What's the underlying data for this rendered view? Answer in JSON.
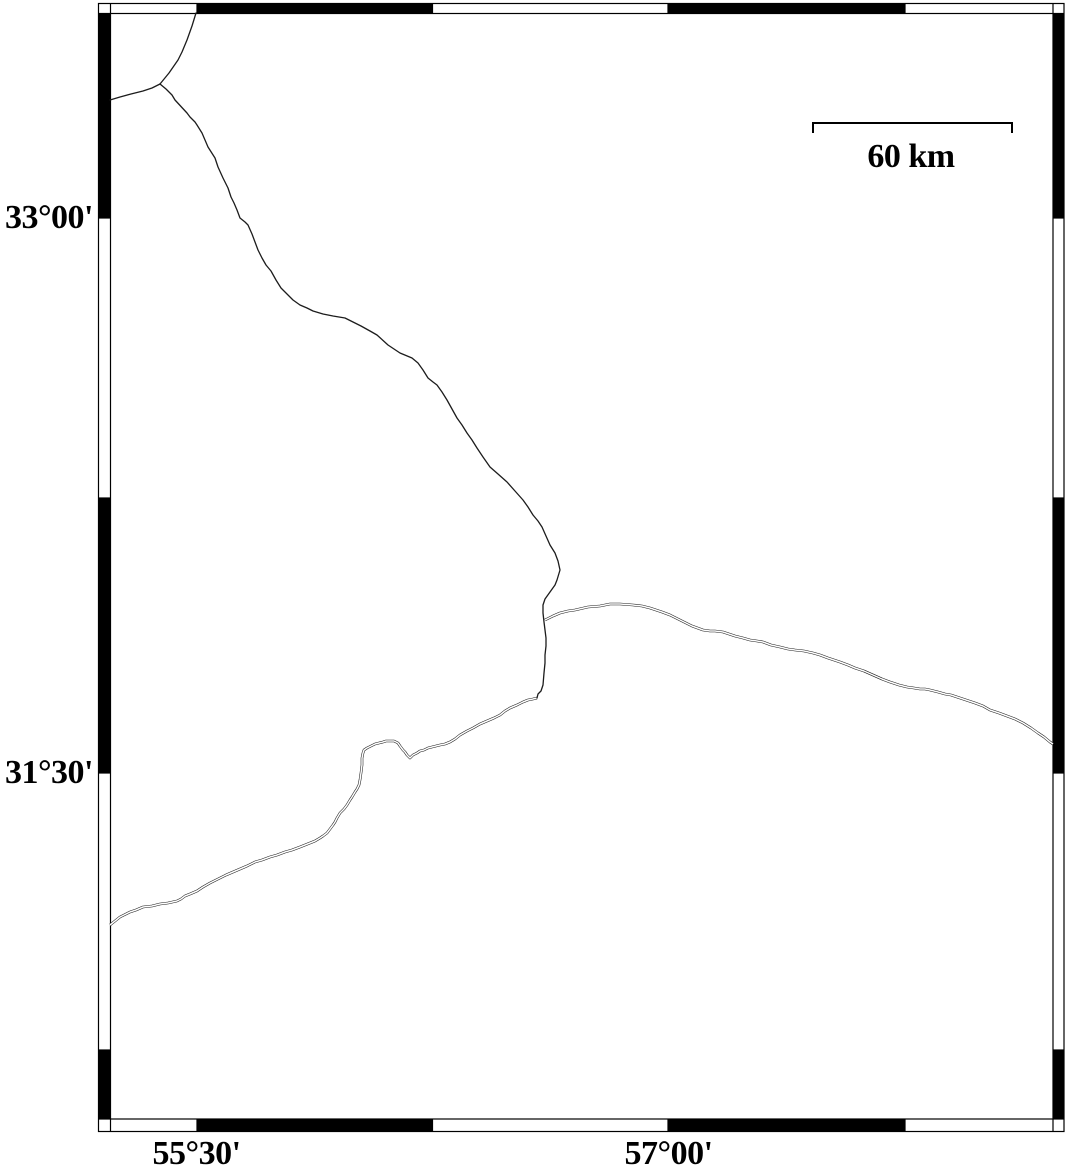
{
  "colors": {
    "ink": "#000000",
    "background": "#ffffff",
    "line": "#1c1c1c"
  },
  "scale_bar": {
    "label": "60 km",
    "x1": 812,
    "x2": 1013,
    "y": 122,
    "tick_height": 11,
    "label_center_x": 911,
    "label_top": 139
  },
  "map_data": {
    "type": "map",
    "grid_annotation_interval": "45 arc-minutes",
    "lat_ticks": [
      {
        "label": "33°00'",
        "y": 218
      },
      {
        "label": "31°30'",
        "y": 773
      }
    ],
    "lon_ticks": [
      {
        "label": "55°30'",
        "x": 196.5
      },
      {
        "label": "57°00'",
        "x": 668.5
      }
    ],
    "lon_label_row_y": 1136,
    "frame": {
      "outer": {
        "x1": 98.5,
        "y1": 3.5,
        "x2": 1064,
        "y2": 1131.5
      },
      "inner": {
        "x1": 110.5,
        "y1": 13.5,
        "x2": 1053,
        "y2": 1119
      },
      "x_boundaries": [
        197,
        432.5,
        668,
        905
      ],
      "y_boundaries": [
        218,
        498,
        773,
        1050
      ],
      "top_black": [
        [
          197,
          432.5
        ],
        [
          668,
          905
        ]
      ],
      "bottom_black": [
        [
          197,
          432.5
        ],
        [
          668,
          905
        ]
      ],
      "left_black": [
        [
          13.5,
          218
        ],
        [
          498,
          773
        ],
        [
          1050,
          1119
        ]
      ],
      "right_black": [
        [
          13.5,
          218
        ],
        [
          498,
          773
        ],
        [
          1050,
          1119
        ]
      ]
    },
    "lines": [
      {
        "id": "boundary-north",
        "kind": "boundary",
        "points": [
          [
            196,
            13
          ],
          [
            192,
            26
          ],
          [
            187,
            40
          ],
          [
            182,
            52
          ],
          [
            178,
            60
          ],
          [
            169,
            73
          ],
          [
            160,
            84
          ]
        ]
      },
      {
        "id": "boundary-west-branch",
        "kind": "boundary",
        "points": [
          [
            160,
            84
          ],
          [
            152,
            88
          ],
          [
            143,
            91
          ],
          [
            131,
            94
          ],
          [
            120,
            97
          ],
          [
            110,
            100
          ]
        ]
      },
      {
        "id": "boundary-main",
        "kind": "boundary",
        "points": [
          [
            160,
            84
          ],
          [
            166,
            89
          ],
          [
            172,
            95
          ],
          [
            175,
            100
          ],
          [
            187,
            113
          ],
          [
            190,
            117
          ],
          [
            195,
            122
          ],
          [
            197,
            125
          ],
          [
            202,
            133
          ],
          [
            208,
            147
          ],
          [
            215,
            158
          ],
          [
            218,
            167
          ],
          [
            223,
            178
          ],
          [
            228,
            188
          ],
          [
            231,
            197
          ],
          [
            234,
            203
          ],
          [
            237,
            210
          ],
          [
            240,
            218
          ],
          [
            245,
            222
          ],
          [
            248,
            225
          ],
          [
            252,
            234
          ],
          [
            255,
            242
          ],
          [
            258,
            250
          ],
          [
            262,
            258
          ],
          [
            266,
            265
          ],
          [
            271,
            271
          ],
          [
            276,
            280
          ],
          [
            281,
            288
          ],
          [
            287,
            294
          ],
          [
            293,
            300
          ],
          [
            300,
            305
          ],
          [
            307,
            308
          ],
          [
            313,
            311
          ],
          [
            323,
            314
          ],
          [
            333,
            316
          ],
          [
            345,
            318
          ],
          [
            353,
            322
          ],
          [
            361,
            326
          ],
          [
            370,
            331
          ],
          [
            377,
            335
          ],
          [
            388,
            345
          ],
          [
            400,
            353
          ],
          [
            412,
            358
          ],
          [
            418,
            363
          ],
          [
            423,
            370
          ],
          [
            428,
            378
          ],
          [
            433,
            382
          ],
          [
            437,
            385
          ],
          [
            442,
            392
          ],
          [
            447,
            400
          ],
          [
            452,
            409
          ],
          [
            457,
            418
          ],
          [
            462,
            425
          ],
          [
            467,
            433
          ],
          [
            472,
            440
          ],
          [
            477,
            448
          ],
          [
            483,
            457
          ],
          [
            490,
            467
          ],
          [
            498,
            474
          ],
          [
            507,
            482
          ],
          [
            515,
            491
          ],
          [
            523,
            500
          ],
          [
            528,
            507
          ],
          [
            533,
            515
          ],
          [
            538,
            521
          ],
          [
            542,
            527
          ],
          [
            546,
            536
          ],
          [
            550,
            545
          ],
          [
            555,
            553
          ],
          [
            558,
            561
          ],
          [
            560,
            570
          ],
          [
            557,
            580
          ],
          [
            555,
            585
          ],
          [
            550,
            592
          ],
          [
            545,
            599
          ],
          [
            543,
            605
          ],
          [
            543,
            613
          ],
          [
            544,
            622
          ],
          [
            545,
            630
          ],
          [
            546,
            638
          ],
          [
            546,
            646
          ],
          [
            545,
            655
          ],
          [
            545,
            663
          ],
          [
            544,
            673
          ],
          [
            543,
            685
          ],
          [
            541,
            691
          ],
          [
            538,
            694
          ],
          [
            537,
            698
          ]
        ]
      },
      {
        "id": "river-east",
        "kind": "river",
        "points": [
          [
            545,
            620
          ],
          [
            553,
            616
          ],
          [
            560,
            613
          ],
          [
            568,
            611
          ],
          [
            575,
            610
          ],
          [
            588,
            607
          ],
          [
            600,
            606
          ],
          [
            610,
            604
          ],
          [
            620,
            604
          ],
          [
            633,
            605
          ],
          [
            642,
            606
          ],
          [
            650,
            608
          ],
          [
            656,
            610
          ],
          [
            662,
            612
          ],
          [
            670,
            615
          ],
          [
            680,
            620
          ],
          [
            686,
            623
          ],
          [
            692,
            626
          ],
          [
            703,
            630
          ],
          [
            710,
            631
          ],
          [
            715,
            631
          ],
          [
            723,
            632
          ],
          [
            729,
            634
          ],
          [
            735,
            636
          ],
          [
            743,
            638
          ],
          [
            750,
            640
          ],
          [
            757,
            641
          ],
          [
            763,
            642
          ],
          [
            771,
            645
          ],
          [
            780,
            647
          ],
          [
            788,
            649
          ],
          [
            795,
            650
          ],
          [
            804,
            651
          ],
          [
            813,
            653
          ],
          [
            820,
            655
          ],
          [
            828,
            658
          ],
          [
            834,
            660
          ],
          [
            840,
            662
          ],
          [
            848,
            665
          ],
          [
            855,
            668
          ],
          [
            864,
            671
          ],
          [
            873,
            675
          ],
          [
            882,
            679
          ],
          [
            890,
            682
          ],
          [
            899,
            685
          ],
          [
            907,
            687
          ],
          [
            914,
            688
          ],
          [
            920,
            689
          ],
          [
            925,
            689
          ],
          [
            930,
            690
          ],
          [
            938,
            692
          ],
          [
            945,
            694
          ],
          [
            951,
            695
          ],
          [
            957,
            697
          ],
          [
            966,
            700
          ],
          [
            975,
            703
          ],
          [
            983,
            706
          ],
          [
            990,
            710
          ],
          [
            999,
            713
          ],
          [
            1007,
            716
          ],
          [
            1015,
            719
          ],
          [
            1023,
            723
          ],
          [
            1031,
            728
          ],
          [
            1038,
            733
          ],
          [
            1044,
            737
          ],
          [
            1050,
            742
          ],
          [
            1053,
            744
          ]
        ]
      },
      {
        "id": "river-southwest",
        "kind": "river",
        "points": [
          [
            537,
            698
          ],
          [
            533,
            699
          ],
          [
            528,
            700
          ],
          [
            523,
            702
          ],
          [
            517,
            705
          ],
          [
            510,
            708
          ],
          [
            505,
            711
          ],
          [
            500,
            715
          ],
          [
            494,
            718
          ],
          [
            487,
            721
          ],
          [
            480,
            724
          ],
          [
            473,
            728
          ],
          [
            467,
            731
          ],
          [
            460,
            735
          ],
          [
            455,
            739
          ],
          [
            450,
            742
          ],
          [
            445,
            744
          ],
          [
            440,
            745
          ],
          [
            436,
            746
          ],
          [
            432,
            747
          ],
          [
            428,
            748
          ],
          [
            424,
            750
          ],
          [
            420,
            751
          ],
          [
            417,
            753
          ],
          [
            413,
            755
          ],
          [
            410,
            758
          ],
          [
            407,
            755
          ],
          [
            405,
            752
          ],
          [
            403,
            750
          ],
          [
            400,
            746
          ],
          [
            398,
            743
          ],
          [
            394,
            741
          ],
          [
            390,
            741
          ],
          [
            386,
            741
          ],
          [
            383,
            742
          ],
          [
            379,
            743
          ],
          [
            375,
            744
          ],
          [
            371,
            746
          ],
          [
            367,
            748
          ],
          [
            364,
            750
          ],
          [
            363,
            753
          ],
          [
            362,
            758
          ],
          [
            362,
            765
          ],
          [
            361,
            773
          ],
          [
            360,
            780
          ],
          [
            359,
            785
          ],
          [
            357,
            789
          ],
          [
            355,
            792
          ],
          [
            352,
            797
          ],
          [
            350,
            800
          ],
          [
            347,
            805
          ],
          [
            344,
            809
          ],
          [
            340,
            813
          ],
          [
            337,
            818
          ],
          [
            335,
            822
          ],
          [
            333,
            825
          ],
          [
            330,
            829
          ],
          [
            327,
            833
          ],
          [
            323,
            836
          ],
          [
            320,
            838
          ],
          [
            315,
            841
          ],
          [
            310,
            843
          ],
          [
            305,
            845
          ],
          [
            300,
            847
          ],
          [
            292,
            850
          ],
          [
            285,
            852
          ],
          [
            277,
            855
          ],
          [
            270,
            857
          ],
          [
            262,
            860
          ],
          [
            255,
            862
          ],
          [
            247,
            866
          ],
          [
            240,
            869
          ],
          [
            233,
            872
          ],
          [
            226,
            875
          ],
          [
            220,
            878
          ],
          [
            214,
            881
          ],
          [
            210,
            883
          ],
          [
            203,
            887
          ],
          [
            197,
            891
          ],
          [
            190,
            894
          ],
          [
            185,
            896
          ],
          [
            181,
            899
          ],
          [
            177,
            901
          ],
          [
            168,
            903
          ],
          [
            160,
            904
          ],
          [
            152,
            906
          ],
          [
            143,
            907
          ],
          [
            136,
            910
          ],
          [
            130,
            912
          ],
          [
            124,
            915
          ],
          [
            120,
            917
          ],
          [
            115,
            921
          ],
          [
            110,
            925
          ]
        ]
      }
    ]
  }
}
